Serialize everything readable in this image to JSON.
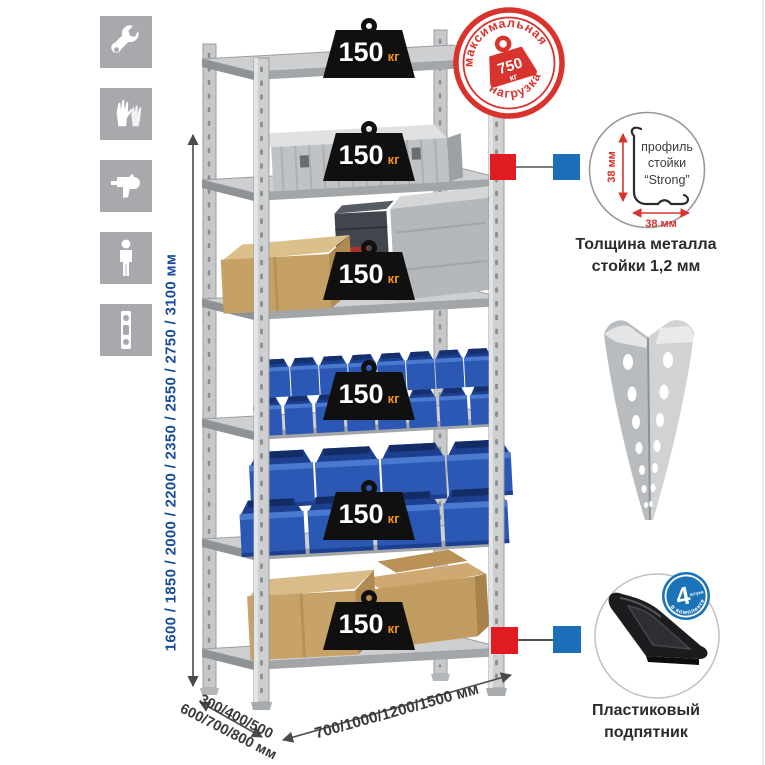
{
  "icons": {
    "items": [
      "wrench",
      "gloves",
      "drill",
      "person-height",
      "spirit-level"
    ]
  },
  "dimensions": {
    "height_label": "1600 / 1850 / 2000 / 2200 / 2350 / 2550 / 2750 / 3100 мм",
    "depth_label_line1": "300/400/500",
    "depth_label_line2": "600/700/800 мм",
    "width_label": "700/1000/1200/1500 мм"
  },
  "shelves": [
    {
      "load": "150",
      "unit": "кг"
    },
    {
      "load": "150",
      "unit": "кг"
    },
    {
      "load": "150",
      "unit": "кг"
    },
    {
      "load": "150",
      "unit": "кг"
    },
    {
      "load": "150",
      "unit": "кг"
    },
    {
      "load": "150",
      "unit": "кг"
    }
  ],
  "max_load_stamp": {
    "arc_top": "максимальная",
    "arc_bottom": "нагрузка",
    "value": "750",
    "unit": "кг"
  },
  "profile_detail": {
    "label_line1": "профиль",
    "label_line2": "стойки",
    "label_line3": "“Strong”",
    "dim_vertical": "38 мм",
    "dim_horizontal": "38 мм",
    "caption_line1": "Толщина металла",
    "caption_line2": "стойки 1,2 мм"
  },
  "foot_detail": {
    "badge_value": "4",
    "badge_small": "штуки",
    "badge_arc": "в комплекте",
    "caption_line1": "Пластиковый",
    "caption_line2": "подпятник"
  },
  "colors": {
    "stamp_red": "#d8332d",
    "marker_red": "#e01b22",
    "marker_blue": "#1b6eb8",
    "dimension_blue": "#1a4b9b",
    "icon_gray": "#a7a9ac",
    "weight_orange": "#f5930f"
  }
}
